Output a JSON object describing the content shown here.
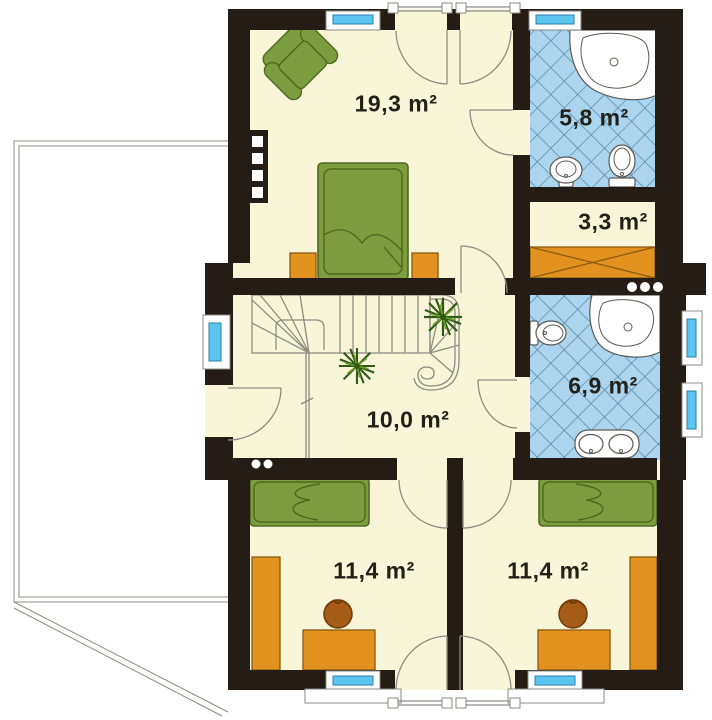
{
  "colors": {
    "wall": "#241c15",
    "floor": "#f8f5d8",
    "tile_fill": "#abd5ee",
    "tile_line": "#4a7ba0",
    "glass": "#5ac6f0",
    "glass_border": "#2e7fae",
    "furniture_green": "#7d9c40",
    "furniture_green_dark": "#50691f",
    "furniture_orange": "#e2931f",
    "furniture_orange_dark": "#8a5a10",
    "chair_brown": "#a55c17",
    "chair_brown_dark": "#6f3c0a",
    "fixture_line": "#5a5a55",
    "plan_line": "#8d8d85",
    "label_text": "#222018",
    "white": "#ffffff"
  },
  "rooms": [
    {
      "area": "19,3 m²"
    },
    {
      "area": "5,8 m²"
    },
    {
      "area": "3,3 m²"
    },
    {
      "area": "6,9 m²"
    },
    {
      "area": "10,0 m²"
    },
    {
      "area": "11,4 m²"
    },
    {
      "area": "11,4 m²"
    }
  ]
}
